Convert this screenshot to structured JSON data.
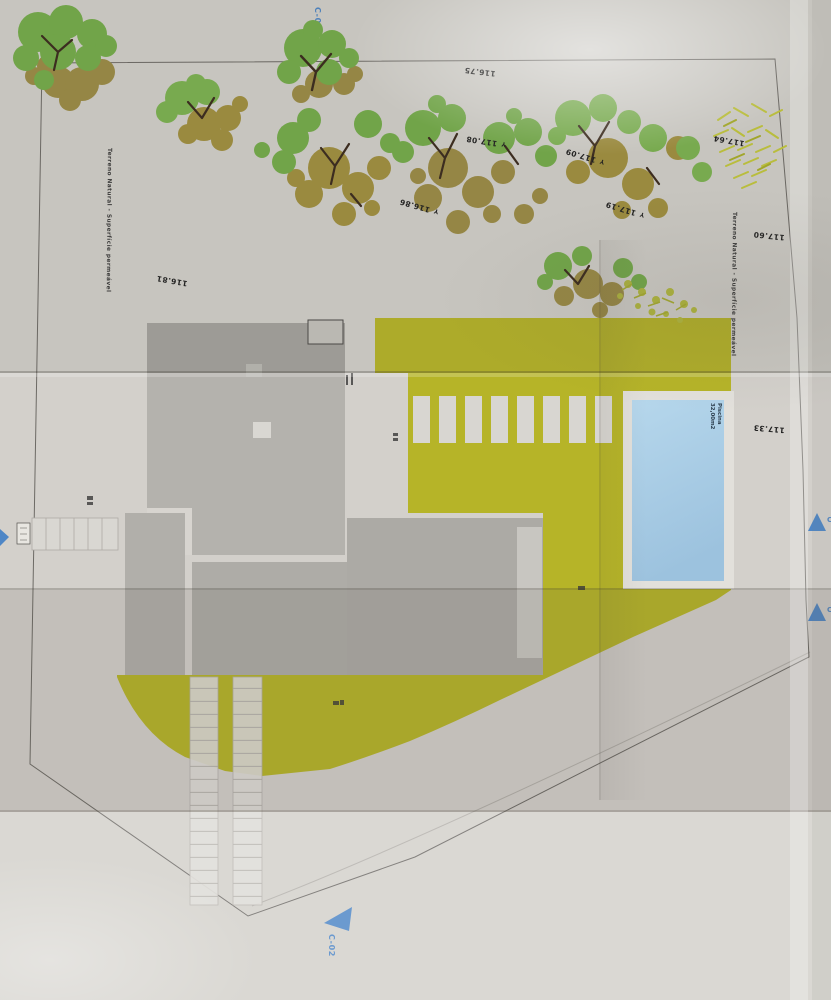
{
  "plan": {
    "annotations": {
      "marker_glyph": "Y",
      "permeable_left": "Terreno Natural - Superfície permeável",
      "permeable_right": "Terreno Natural - Superfície permeável",
      "elevations": [
        {
          "value": "116.75",
          "has_marker": false
        },
        {
          "value": "117.08",
          "has_marker": true
        },
        {
          "value": "117.09",
          "has_marker": true
        },
        {
          "value": "116.86",
          "has_marker": true
        },
        {
          "value": "117.19",
          "has_marker": true
        },
        {
          "value": "117.64",
          "has_marker": false
        },
        {
          "value": "117.60",
          "has_marker": false
        },
        {
          "value": "116.81",
          "has_marker": false
        },
        {
          "value": "117.33",
          "has_marker": false
        }
      ]
    },
    "markers": {
      "section_top": "C-02",
      "section_bottom": "C-02",
      "section_right_upper": "C",
      "section_right_lower": "C"
    },
    "pool": {
      "name": "Piscina",
      "area": "32,00m2"
    },
    "colors": {
      "terrain_yellow": "#b6b428",
      "pool_blue": "#a5cbe4",
      "building_gray": "#b2b0ab",
      "marker_blue": "#4e86c6",
      "tree_green": "#74ac4a",
      "tree_olive": "#9c8c45",
      "paper": "#d3d0cb"
    }
  }
}
